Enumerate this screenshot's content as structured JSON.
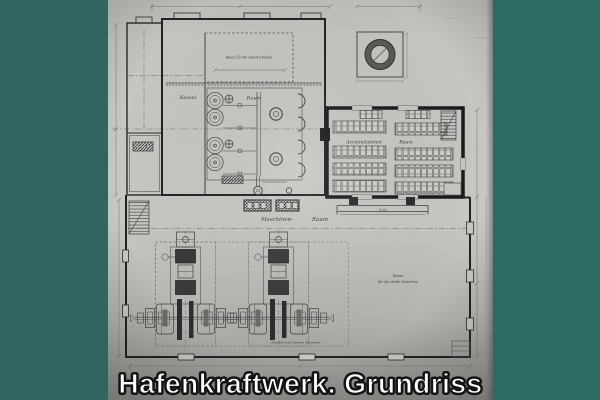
{
  "photo": {
    "caption": "Hafenkraftwerk. Grundriss"
  },
  "colors": {
    "frame_teal_left": "#336560",
    "frame_teal_right": "#2d6a62",
    "paper_light": "#c9c8c4",
    "paper_dark_bottom": "#8e8d89",
    "ink": "#3f3f3f",
    "wall_dark": "#1d1d1d",
    "caption_text": "#ffffff",
    "caption_outline": "#161616"
  },
  "plan_labels": {
    "boiler_room_word1": "Kessel",
    "boiler_room_word2": "Raum",
    "accumulator_room_word1": "Accumulatoren",
    "accumulator_room_word2": "Raum",
    "machine_hall_word1": "Maschinen-",
    "machine_hall_word2": "Raum",
    "future_boiler_note": "Raum für die zweiten Kessel",
    "third_machine_note_line1": "Raum",
    "third_machine_note_line2": "für die dritte Maschine",
    "channel_note": "Kanal",
    "engine_note": "Marshall'sche liegende Maschinen"
  }
}
